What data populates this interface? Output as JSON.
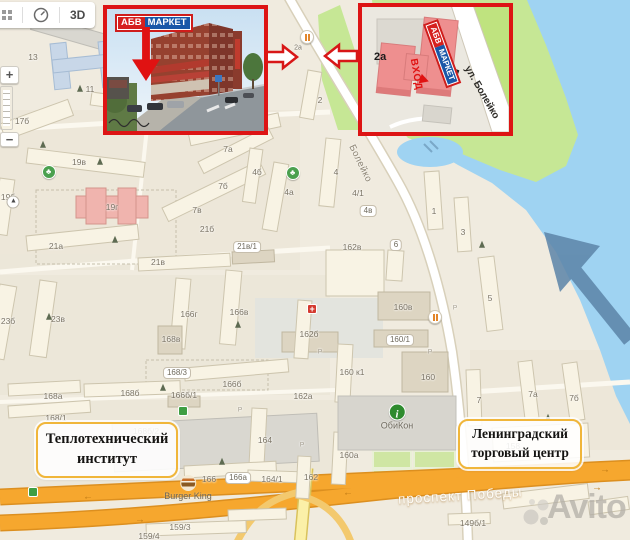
{
  "controls": {
    "view_3d": "3D",
    "zoom_in": "+",
    "zoom_out": "−"
  },
  "insets": {
    "photo": {
      "logo_abv": "АБВ",
      "logo_market": "МАРКЕТ"
    },
    "map": {
      "logo_abv": "АБВ",
      "logo_market": "МАРКЕТ",
      "building": "2а",
      "entrance": "ВХОД",
      "street": "ул. Болейко"
    }
  },
  "landmark_boxes": [
    {
      "line1": "Теплотехнический",
      "line2": "институт"
    },
    {
      "line1": "Ленинградский",
      "line2": "торговый центр"
    }
  ],
  "street_labels": {
    "boleyko": "Болейко",
    "pobedy": "проспект Победы"
  },
  "poi_labels": {
    "burger_king": "Burger King",
    "obikon": "ОбиКон",
    "marker_2a": "2а"
  },
  "watermark": "Avito",
  "colors": {
    "accent_red": "#dd1414",
    "label_border": "#f0b63a",
    "road_orange": "#f6a72e",
    "water": "#9fd3f2",
    "park_green": "#c6e795",
    "logo_red": "#d6201f",
    "logo_blue": "#1a57a8"
  },
  "map_labels": [
    {
      "t": "1",
      "x": 51,
      "y": 24
    },
    {
      "t": "13",
      "x": 33,
      "y": 57
    },
    {
      "t": "11",
      "x": 90,
      "y": 89
    },
    {
      "t": "17б",
      "x": 22,
      "y": 121
    },
    {
      "t": "19в",
      "x": 79,
      "y": 162
    },
    {
      "t": "19б",
      "x": 8,
      "y": 197
    },
    {
      "t": "19г",
      "x": 112,
      "y": 207
    },
    {
      "t": "21а",
      "x": 56,
      "y": 246
    },
    {
      "t": "21б",
      "x": 207,
      "y": 229
    },
    {
      "t": "21в",
      "x": 158,
      "y": 262
    },
    {
      "t": "21в/1",
      "x": 247,
      "y": 247,
      "s": "pill"
    },
    {
      "t": "7а",
      "x": 228,
      "y": 149
    },
    {
      "t": "7б",
      "x": 223,
      "y": 186
    },
    {
      "t": "7в",
      "x": 197,
      "y": 210
    },
    {
      "t": "4б",
      "x": 257,
      "y": 172
    },
    {
      "t": "4а",
      "x": 289,
      "y": 192
    },
    {
      "t": "4",
      "x": 336,
      "y": 172
    },
    {
      "t": "4/1",
      "x": 358,
      "y": 193
    },
    {
      "t": "4в",
      "x": 368,
      "y": 211,
      "s": "pill"
    },
    {
      "t": "2",
      "x": 320,
      "y": 100
    },
    {
      "t": "162в",
      "x": 352,
      "y": 247
    },
    {
      "t": "6",
      "x": 396,
      "y": 245,
      "s": "pill"
    },
    {
      "t": "1",
      "x": 434,
      "y": 211
    },
    {
      "t": "3",
      "x": 463,
      "y": 232
    },
    {
      "t": "5",
      "x": 490,
      "y": 298
    },
    {
      "t": "23б",
      "x": 8,
      "y": 321
    },
    {
      "t": "23в",
      "x": 58,
      "y": 319
    },
    {
      "t": "166г",
      "x": 189,
      "y": 314
    },
    {
      "t": "166в",
      "x": 239,
      "y": 312
    },
    {
      "t": "168в",
      "x": 171,
      "y": 339
    },
    {
      "t": "162б",
      "x": 309,
      "y": 334
    },
    {
      "t": "168/3",
      "x": 177,
      "y": 373,
      "s": "pill"
    },
    {
      "t": "166б",
      "x": 232,
      "y": 384
    },
    {
      "t": "168б",
      "x": 130,
      "y": 393
    },
    {
      "t": "166б/1",
      "x": 184,
      "y": 395
    },
    {
      "t": "168а",
      "x": 53,
      "y": 396
    },
    {
      "t": "162а",
      "x": 303,
      "y": 396
    },
    {
      "t": "168/1",
      "x": 56,
      "y": 418
    },
    {
      "t": "168б/2",
      "x": 146,
      "y": 431
    },
    {
      "t": "164",
      "x": 265,
      "y": 440
    },
    {
      "t": "166",
      "x": 209,
      "y": 479
    },
    {
      "t": "166а",
      "x": 238,
      "y": 478,
      "s": "pill"
    },
    {
      "t": "164/1",
      "x": 272,
      "y": 479
    },
    {
      "t": "162",
      "x": 311,
      "y": 477
    },
    {
      "t": "160в",
      "x": 403,
      "y": 307
    },
    {
      "t": "160/1",
      "x": 400,
      "y": 340,
      "s": "pill"
    },
    {
      "t": "160 к1",
      "x": 352,
      "y": 372
    },
    {
      "t": "160",
      "x": 428,
      "y": 377
    },
    {
      "t": "160а",
      "x": 349,
      "y": 455
    },
    {
      "t": "7",
      "x": 479,
      "y": 400
    },
    {
      "t": "7а",
      "x": 533,
      "y": 394
    },
    {
      "t": "7б",
      "x": 574,
      "y": 398
    },
    {
      "t": "158",
      "x": 513,
      "y": 446
    },
    {
      "t": "149б/1",
      "x": 473,
      "y": 523
    },
    {
      "t": "159/3",
      "x": 180,
      "y": 527
    },
    {
      "t": "159/4",
      "x": 149,
      "y": 536
    },
    {
      "t": "Р",
      "x": 320,
      "y": 352,
      "s": "tiny"
    },
    {
      "t": "Р",
      "x": 430,
      "y": 352,
      "s": "tiny"
    },
    {
      "t": "Р",
      "x": 455,
      "y": 308,
      "s": "tiny"
    },
    {
      "t": "Р",
      "x": 240,
      "y": 410,
      "s": "tiny"
    },
    {
      "t": "Р",
      "x": 302,
      "y": 445,
      "s": "tiny"
    }
  ],
  "trees": [
    [
      80,
      89
    ],
    [
      43,
      145
    ],
    [
      100,
      162
    ],
    [
      115,
      240
    ],
    [
      49,
      317
    ],
    [
      238,
      325
    ],
    [
      163,
      388
    ],
    [
      222,
      462
    ],
    [
      482,
      245
    ],
    [
      548,
      418
    ]
  ],
  "pois": [
    {
      "type": "restaurant",
      "x": 307,
      "y": 37
    },
    {
      "type": "restaurant",
      "x": 435,
      "y": 317
    },
    {
      "type": "playground",
      "x": 49,
      "y": 172
    },
    {
      "type": "playground",
      "x": 293,
      "y": 173
    },
    {
      "type": "transit",
      "x": 183,
      "y": 411
    },
    {
      "type": "transit",
      "x": 33,
      "y": 492
    },
    {
      "type": "medical",
      "x": 312,
      "y": 309
    },
    {
      "type": "compass",
      "x": 13,
      "y": 202
    }
  ],
  "road_arrows": [
    {
      "x": 88,
      "y": 497,
      "g": "←"
    },
    {
      "x": 348,
      "y": 493,
      "g": "←"
    },
    {
      "x": 605,
      "y": 470,
      "g": "→"
    },
    {
      "x": 597,
      "y": 488,
      "g": "→"
    },
    {
      "x": 140,
      "y": 520,
      "g": "→"
    }
  ]
}
